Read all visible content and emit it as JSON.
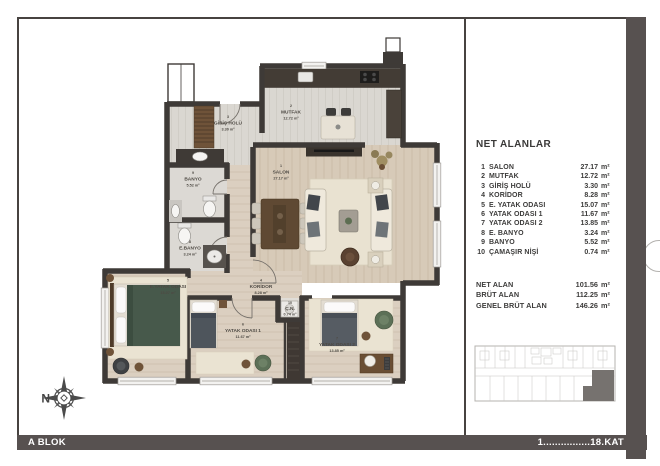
{
  "footer": {
    "block_label": "A BLOK",
    "floor_label": "1................18.KAT 3+1"
  },
  "compass": {
    "north_label": "N"
  },
  "legend": {
    "title": "NET ALANLAR",
    "rows": [
      {
        "num": "1",
        "name": "SALON",
        "area": "27.17",
        "unit": "m²"
      },
      {
        "num": "2",
        "name": "MUTFAK",
        "area": "12.72",
        "unit": "m²"
      },
      {
        "num": "3",
        "name": "GİRİŞ HOLÜ",
        "area": "3.30",
        "unit": "m²"
      },
      {
        "num": "4",
        "name": "KORİDOR",
        "area": "8.28",
        "unit": "m²"
      },
      {
        "num": "5",
        "name": "E. YATAK ODASI",
        "area": "15.07",
        "unit": "m²"
      },
      {
        "num": "6",
        "name": "YATAK ODASI 1",
        "area": "11.67",
        "unit": "m²"
      },
      {
        "num": "7",
        "name": "YATAK ODASI 2",
        "area": "13.85",
        "unit": "m²"
      },
      {
        "num": "8",
        "name": "E. BANYO",
        "area": "3.24",
        "unit": "m²"
      },
      {
        "num": "9",
        "name": "BANYO",
        "area": "5.52",
        "unit": "m²"
      },
      {
        "num": "10",
        "name": "ÇAMAŞIR NİŞİ",
        "area": "0.74",
        "unit": "m²"
      }
    ],
    "totals": [
      {
        "name": "NET ALAN",
        "area": "101.56",
        "unit": "m²"
      },
      {
        "name": "BRÜT ALAN",
        "area": "112.25",
        "unit": "m²"
      },
      {
        "name": "GENEL BRÜT ALAN",
        "area": "146.26",
        "unit": "m²"
      }
    ]
  },
  "plan": {
    "labels": [
      {
        "num": "1",
        "name": "SALON",
        "area": "27.17 m²"
      },
      {
        "num": "2",
        "name": "MUTFAK",
        "area": "12.72 m²"
      },
      {
        "num": "3",
        "name": "GİRİŞ HOLÜ",
        "area": "3.30 m²"
      },
      {
        "num": "4",
        "name": "KORİDOR",
        "area": "8.28 m²"
      },
      {
        "num": "5",
        "name": "E.YATAK ODASI",
        "area": "15.07 m²"
      },
      {
        "num": "6",
        "name": "YATAK ODASI 1",
        "area": "11.67 m²"
      },
      {
        "num": "7",
        "name": "YATAK ODASI 2",
        "area": "13.85 m²"
      },
      {
        "num": "8",
        "name": "E.BANYO",
        "area": "3.24 m²"
      },
      {
        "num": "9",
        "name": "BANYO",
        "area": "5.52 m²"
      },
      {
        "num": "10",
        "name": "Ç.N.",
        "area": "0.74 m²"
      }
    ]
  },
  "colors": {
    "frame": "#575150",
    "wall": "#3e3a37",
    "wood": "#d7cab8"
  }
}
